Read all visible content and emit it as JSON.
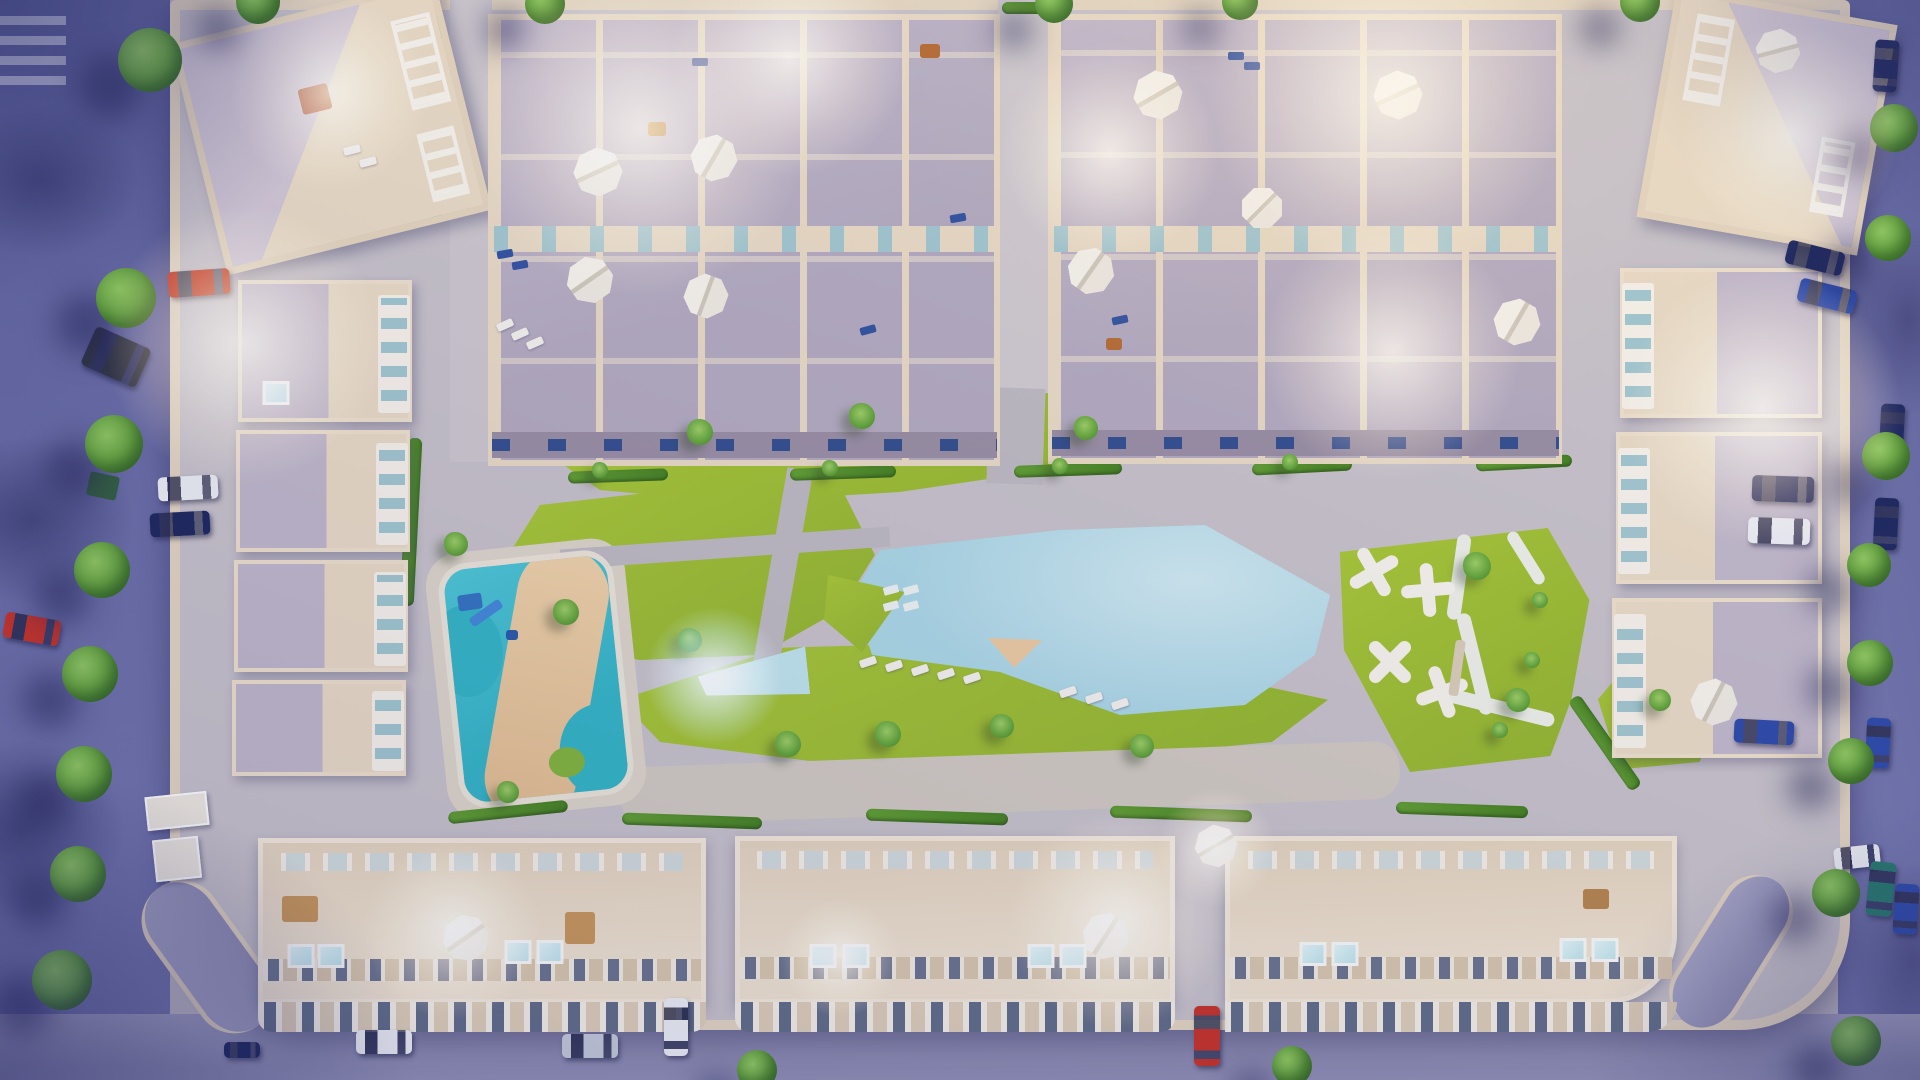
{
  "scene": {
    "description": "Aerial top-down 3D render at dusk of a rectangular residential apartment complex with perimeter streets, parked cars and street trees; interior amenity courtyard with a large free-form swimming pool, a glowing lap-pool arm, a turquoise kids water-park pool with winding sand path and blue waterslide, yellow-green lawns with palm trees, a playground island with white jack-shaped climbing structures, rooftop terrace townhouse blocks with white umbrellas and warm lit units, and three long apartment buildings along the bottom with skylight rows and glass jacuzzis.",
    "time_of_day": "dusk",
    "view": "top-down aerial",
    "visible_text": ""
  },
  "palette": {
    "plaza": "#c6c1c9",
    "curb": "#e3d5c0",
    "roof": "#bfb6c9",
    "wall": "#e9dac4",
    "lawn": "#a8c832",
    "lawnDark": "#8fb32a",
    "pool": "#a9d7e6",
    "poolLight": "#cfeaf2",
    "kids": "#2fb4c6",
    "sand": "#ecc9a0",
    "deck": "#d0c9c1"
  },
  "car_colors": {
    "red": "#c62f24",
    "navy": "#18235c",
    "blue": "#2746a8",
    "white": "#eceef4",
    "silver": "#c3c9d8",
    "teal": "#20756a",
    "dark": "#2b3040"
  },
  "decor": {
    "trees": [
      [
        150,
        60,
        64
      ],
      [
        126,
        298,
        60
      ],
      [
        114,
        444,
        58
      ],
      [
        102,
        570,
        56
      ],
      [
        90,
        674,
        56
      ],
      [
        84,
        774,
        56
      ],
      [
        78,
        874,
        56
      ],
      [
        62,
        980,
        60
      ],
      [
        258,
        2,
        44
      ],
      [
        545,
        4,
        40
      ],
      [
        1054,
        4,
        38
      ],
      [
        1240,
        2,
        36
      ],
      [
        1640,
        2,
        40
      ],
      [
        1894,
        128,
        48
      ],
      [
        1888,
        238,
        46
      ],
      [
        1886,
        456,
        48
      ],
      [
        1869,
        565,
        44
      ],
      [
        1870,
        663,
        46
      ],
      [
        1851,
        761,
        46
      ],
      [
        1836,
        893,
        48
      ],
      [
        1856,
        1041,
        50
      ],
      [
        757,
        1070,
        40
      ],
      [
        1292,
        1066,
        40
      ]
    ],
    "palms": [
      [
        700,
        432,
        26
      ],
      [
        862,
        416,
        26
      ],
      [
        1086,
        428,
        24
      ],
      [
        566,
        612,
        26
      ],
      [
        690,
        640,
        24
      ],
      [
        788,
        744,
        26
      ],
      [
        888,
        734,
        26
      ],
      [
        1002,
        726,
        24
      ],
      [
        1142,
        746,
        24
      ],
      [
        1477,
        566,
        28
      ],
      [
        1518,
        700,
        24
      ],
      [
        456,
        544,
        24
      ],
      [
        508,
        792,
        22
      ],
      [
        1660,
        700,
        22
      ],
      [
        600,
        470,
        16
      ],
      [
        830,
        468,
        16
      ],
      [
        1060,
        466,
        16
      ],
      [
        1290,
        462,
        16
      ],
      [
        1540,
        600,
        16
      ],
      [
        1532,
        660,
        16
      ],
      [
        1500,
        730,
        16
      ]
    ],
    "hedges": [
      [
        618,
        476,
        100,
        12,
        -2
      ],
      [
        843,
        473,
        106,
        12,
        -2
      ],
      [
        1068,
        470,
        108,
        12,
        -2
      ],
      [
        1302,
        467,
        100,
        12,
        -3
      ],
      [
        1524,
        463,
        96,
        12,
        -3
      ],
      [
        692,
        821,
        140,
        12,
        2
      ],
      [
        937,
        817,
        142,
        12,
        2
      ],
      [
        1181,
        814,
        142,
        12,
        2
      ],
      [
        1462,
        810,
        132,
        12,
        2
      ],
      [
        411,
        522,
        14,
        168,
        3
      ],
      [
        437,
        119,
        10,
        206,
        0
      ],
      [
        1605,
        743,
        14,
        110,
        -35
      ],
      [
        508,
        812,
        120,
        12,
        -6
      ],
      [
        1024,
        8,
        44,
        12,
        0
      ]
    ],
    "cars": [
      [
        199,
        283,
        62,
        26,
        -4,
        "red"
      ],
      [
        116,
        357,
        60,
        42,
        24,
        "dark"
      ],
      [
        188,
        488,
        60,
        24,
        -3,
        "white"
      ],
      [
        180,
        524,
        60,
        24,
        -3,
        "navy"
      ],
      [
        32,
        629,
        56,
        26,
        10,
        "red"
      ],
      [
        1783,
        489,
        62,
        26,
        2,
        "navy"
      ],
      [
        1779,
        531,
        62,
        26,
        2,
        "white"
      ],
      [
        1764,
        732,
        60,
        24,
        3,
        "blue"
      ],
      [
        1815,
        258,
        58,
        24,
        14,
        "navy"
      ],
      [
        1827,
        296,
        58,
        24,
        14,
        "blue"
      ],
      [
        1886,
        66,
        24,
        52,
        4,
        "navy"
      ],
      [
        1892,
        430,
        24,
        52,
        3,
        "navy"
      ],
      [
        1886,
        524,
        24,
        52,
        3,
        "navy"
      ],
      [
        1878,
        743,
        24,
        50,
        3,
        "blue"
      ],
      [
        1857,
        857,
        46,
        22,
        -6,
        "white"
      ],
      [
        1881,
        889,
        26,
        54,
        6,
        "teal"
      ],
      [
        1906,
        909,
        24,
        50,
        4,
        "blue"
      ],
      [
        676,
        1027,
        24,
        58,
        0,
        "white"
      ],
      [
        1207,
        1036,
        26,
        60,
        0,
        "red"
      ],
      [
        384,
        1042,
        56,
        24,
        0,
        "white"
      ],
      [
        590,
        1046,
        56,
        24,
        0,
        "silver"
      ],
      [
        242,
        1050,
        36,
        16,
        0,
        "navy"
      ]
    ],
    "umbrellas": [
      [
        598,
        172,
        46,
        20
      ],
      [
        714,
        158,
        44,
        -15
      ],
      [
        590,
        280,
        44,
        10
      ],
      [
        706,
        296,
        42,
        -25
      ],
      [
        1158,
        95,
        46,
        15
      ],
      [
        1091,
        271,
        44,
        -10
      ],
      [
        1398,
        95,
        46,
        20
      ],
      [
        1517,
        322,
        44,
        -15
      ],
      [
        1262,
        208,
        40,
        0
      ],
      [
        466,
        938,
        44,
        10
      ],
      [
        1106,
        936,
        44,
        -12
      ],
      [
        1216,
        846,
        40,
        15
      ],
      [
        1778,
        51,
        42,
        30
      ],
      [
        1714,
        702,
        44,
        -18
      ]
    ],
    "glows": [
      [
        640,
        128,
        170,
        "w"
      ],
      [
        790,
        58,
        120,
        "w"
      ],
      [
        1386,
        98,
        180,
        "w"
      ],
      [
        1392,
        352,
        130,
        "w"
      ],
      [
        1110,
        152,
        110,
        "w"
      ],
      [
        244,
        344,
        140,
        "w"
      ],
      [
        330,
        92,
        100,
        "w"
      ],
      [
        1762,
        408,
        140,
        "w"
      ],
      [
        1790,
        134,
        110,
        "w"
      ],
      [
        1118,
        920,
        110,
        "w"
      ],
      [
        452,
        930,
        90,
        "w"
      ],
      [
        1216,
        848,
        60,
        "w"
      ],
      [
        840,
        958,
        60,
        "w"
      ],
      [
        714,
        676,
        70,
        "c"
      ]
    ],
    "sunbeds": [
      [
        868,
        662,
        -18
      ],
      [
        894,
        666,
        -18
      ],
      [
        920,
        670,
        -18
      ],
      [
        946,
        674,
        -18
      ],
      [
        972,
        678,
        -18
      ],
      [
        1068,
        692,
        -18
      ],
      [
        1094,
        698,
        -18
      ],
      [
        1120,
        704,
        -18
      ],
      [
        505,
        325,
        -24
      ],
      [
        520,
        334,
        -24
      ],
      [
        535,
        343,
        -24
      ],
      [
        352,
        150,
        -14
      ],
      [
        368,
        162,
        -14
      ]
    ],
    "loungers": [
      [
        505,
        254,
        -10
      ],
      [
        520,
        265,
        -10
      ],
      [
        1236,
        56,
        0
      ],
      [
        1252,
        66,
        0
      ],
      [
        868,
        330,
        -15
      ],
      [
        700,
        62,
        0
      ],
      [
        958,
        218,
        -10
      ],
      [
        1120,
        320,
        -12
      ]
    ],
    "glass": [
      [
        301,
        956
      ],
      [
        331,
        956
      ],
      [
        518,
        952
      ],
      [
        550,
        952
      ],
      [
        823,
        956
      ],
      [
        856,
        956
      ],
      [
        1041,
        956
      ],
      [
        1073,
        956
      ],
      [
        1313,
        954
      ],
      [
        1345,
        954
      ],
      [
        1573,
        950
      ],
      [
        1605,
        950
      ],
      [
        276,
        393
      ]
    ],
    "steps": [
      [
        891,
        590
      ],
      [
        911,
        590
      ],
      [
        891,
        606
      ],
      [
        911,
        606
      ]
    ],
    "props": [
      [
        315,
        99,
        30,
        26,
        "#a83a30",
        -14
      ],
      [
        300,
        909,
        36,
        26,
        "#c79557",
        0
      ],
      [
        580,
        928,
        30,
        32,
        "#c79557",
        0
      ],
      [
        1596,
        899,
        26,
        20,
        "#b5824a",
        0
      ],
      [
        657,
        129,
        18,
        14,
        "#b5692f",
        0
      ],
      [
        930,
        51,
        20,
        14,
        "#b5692f",
        0
      ],
      [
        1457,
        668,
        10,
        56,
        "#d9cdb8",
        8
      ],
      [
        470,
        602,
        24,
        16,
        "#2f6fc0",
        -8
      ],
      [
        486,
        613,
        36,
        10,
        "#3f86d8",
        -35
      ],
      [
        512,
        635,
        12,
        10,
        "#2456a8",
        0
      ],
      [
        103,
        486,
        30,
        24,
        "#2e5d3a",
        12
      ],
      [
        1114,
        344,
        16,
        12,
        "#b5692f",
        0
      ]
    ],
    "kiosks": [
      [
        177,
        811,
        62,
        34,
        -6
      ],
      [
        177,
        859,
        46,
        42,
        -6
      ]
    ],
    "xshapes": [
      [
        1374,
        572,
        15
      ],
      [
        1428,
        590,
        40
      ],
      [
        1390,
        662,
        0
      ],
      [
        1442,
        692,
        25
      ]
    ]
  }
}
